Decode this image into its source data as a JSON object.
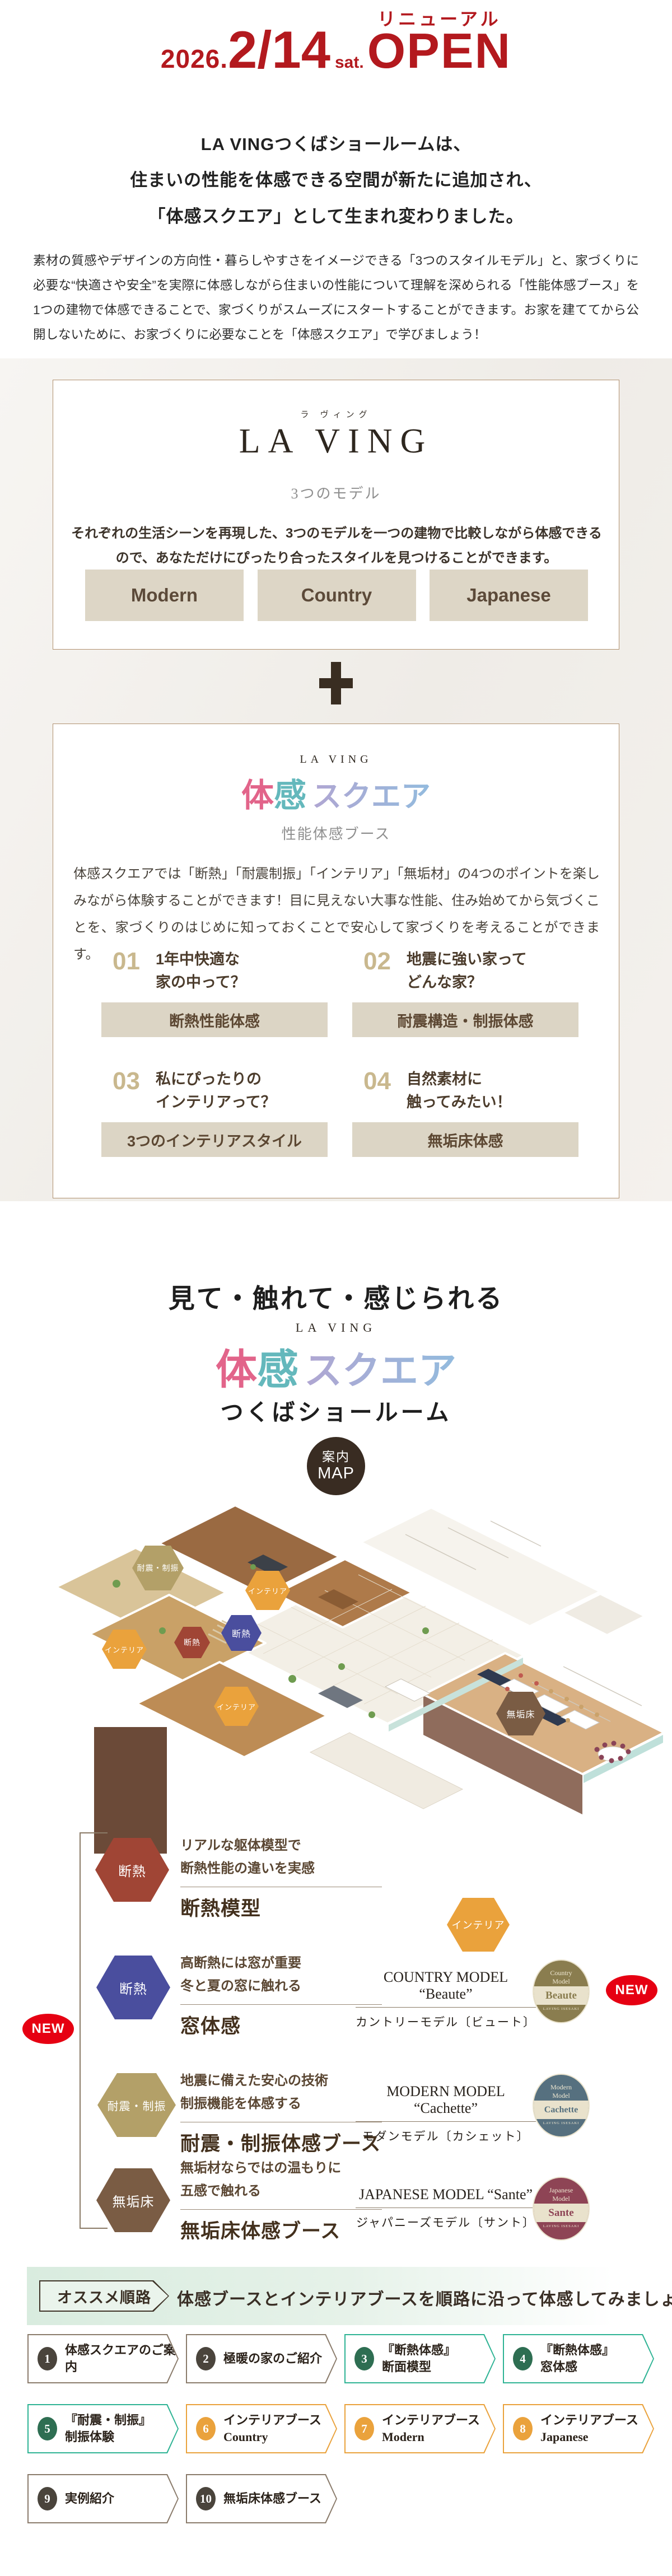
{
  "colors": {
    "accent_red": "#b3191e",
    "badge_red": "#e60012",
    "brown_text": "#4c3a2a",
    "beige_bg": "#f4f1ec",
    "button_beige": "#ddd6c6",
    "label_beige": "#dcd5c5",
    "hex_orange": "#eaa23c",
    "hex_navy": "#4a4e9e",
    "hex_brick": "#a04535",
    "hex_khaki": "#b3a068",
    "hex_brown": "#7a5c44",
    "route_green": "#2eb394",
    "route_orange": "#eaa23c",
    "route_brown": "#8a7b6b",
    "taikan_pink": "#e2648a",
    "taikan_teal": "#64b8bc",
    "taikan_purple": "#a8a4d4",
    "badge_olive": "#8a7d4f",
    "badge_slate": "#56707f",
    "badge_maroon": "#8e4455"
  },
  "header": {
    "year": "2026.",
    "date": "2/14",
    "day": "sat.",
    "renewal": "リニューアル",
    "open": "OPEN"
  },
  "intro": {
    "line1": "LA VINGつくばショールームは、",
    "line2": "住まいの性能を体感できる空間が新たに追加され、",
    "line3": "「体感スクエア」として生まれ変わりました。",
    "body": "素材の質感やデザインの方向性・暮らしやすさをイメージできる「3つのスタイルモデル」と、家づくりに必要な“快適さや安全”を実際に体感しながら住まいの性能について理解を深められる「性能体感ブース」を1つの建物で体感できることで、家づくりがスムーズにスタートすることができます。お家を建ててから公開しないために、お家づくりに必要なことを「体感スクエア」で学びましょう！"
  },
  "models_box": {
    "furigana": "ラ ヴィング",
    "logo": "LA VING",
    "subtitle": "3つのモデル",
    "description": "それぞれの生活シーンを再現した、3つのモデルを一つの建物で比較しながら体感できるので、あなただけにぴったり合ったスタイルを見つけることができます。",
    "buttons": [
      "Modern",
      "Country",
      "Japanese"
    ]
  },
  "taikan_box": {
    "logo": "LA VING",
    "title": {
      "part1": "体",
      "part2": "感",
      "part3": "スクエア"
    },
    "subtitle": "性能体感ブース",
    "description": "体感スクエアでは「断熱」「耐震制振」「インテリア」「無垢材」の4つのポイントを楽しみながら体験することができます！目に見えない大事な性能、住み始めてから気づくことを、家づくりのはじめに知っておくことで安心して家づくりを考えることができます。",
    "points": [
      {
        "num": "01",
        "q1": "1年中快適な",
        "q2": "家の中って？",
        "label": "断熱性能体感"
      },
      {
        "num": "02",
        "q1": "地震に強い家って",
        "q2": "どんな家？",
        "label": "耐震構造・制振体感"
      },
      {
        "num": "03",
        "q1": "私にぴったりの",
        "q2": "インテリアって？",
        "label": "3つのインテリアスタイル"
      },
      {
        "num": "04",
        "q1": "自然素材に",
        "q2": "触ってみたい！",
        "label": "無垢床体感"
      }
    ]
  },
  "showroom": {
    "catch": "見て・触れて・感じられる",
    "logo": "LA VING",
    "title": {
      "part1": "体",
      "part2": "感",
      "part3": "スクエア"
    },
    "subtitle": "つくばショールーム",
    "map_badge_line1": "案内",
    "map_badge_line2": "MAP"
  },
  "map": {
    "hexagons": [
      {
        "label": "耐震・制振"
      },
      {
        "label": "インテリア"
      },
      {
        "label": "断熱"
      },
      {
        "label": "断熱"
      },
      {
        "label": "インテリア"
      },
      {
        "label": "インテリア"
      },
      {
        "label": "無垢床"
      }
    ]
  },
  "legend": {
    "new_label": "NEW",
    "booths": [
      {
        "hex": "断熱",
        "desc1": "リアルな躯体模型で",
        "desc2": "断熱性能の違いを実感",
        "title": "断熱模型"
      },
      {
        "hex": "断熱",
        "desc1": "高断熱には窓が重要",
        "desc2": "冬と夏の窓に触れる",
        "title": "窓体感"
      },
      {
        "hex": "耐震・制振",
        "desc1": "地震に備えた安心の技術",
        "desc2": "制振機能を体感する",
        "title": "耐震・制振体感ブース"
      },
      {
        "hex": "無垢床",
        "desc1": "無垢材ならではの温もりに",
        "desc2": "五感で触れる",
        "title": "無垢床体感ブース"
      }
    ],
    "interior_hex": "インテリア",
    "models": [
      {
        "title": "COUNTRY MODEL “Beaute”",
        "jp": "カントリーモデル〔ビュート〕",
        "badge_top1": "Country",
        "badge_top2": "Model",
        "badge_name": "Beaute",
        "badge_bottom": "LAVING ISESAKI"
      },
      {
        "title": "MODERN MODEL “Cachette”",
        "jp": "モダンモデル〔カシェット〕",
        "badge_top1": "Modern",
        "badge_top2": "Model",
        "badge_name": "Cachette",
        "badge_bottom": "LAVING ISESAKI"
      },
      {
        "title": "JAPANESE MODEL “Sante”",
        "jp": "ジャパニーズモデル〔サント〕",
        "badge_top1": "Japanese",
        "badge_top2": "Model",
        "badge_name": "Sante",
        "badge_bottom": "LAVING ISESAKI"
      }
    ]
  },
  "route": {
    "tag": "オススメ順路",
    "heading": "体感ブースとインテリアブースを順路に沿って体感してみましょう",
    "steps": [
      {
        "num": "1",
        "line1": "体感スクエアのご案内",
        "line2": ""
      },
      {
        "num": "2",
        "line1": "極暖の家のご紹介",
        "line2": ""
      },
      {
        "num": "3",
        "line1": "『断熱体感』",
        "line2": "断面模型"
      },
      {
        "num": "4",
        "line1": "『断熱体感』",
        "line2": "窓体感"
      },
      {
        "num": "5",
        "line1": "『耐震・制振』",
        "line2": "制振体験"
      },
      {
        "num": "6",
        "line1": "インテリアブース",
        "line2": "Country"
      },
      {
        "num": "7",
        "line1": "インテリアブース",
        "line2": "Modern"
      },
      {
        "num": "8",
        "line1": "インテリアブース",
        "line2": "Japanese"
      },
      {
        "num": "9",
        "line1": "実例紹介",
        "line2": ""
      },
      {
        "num": "10",
        "line1": "無垢床体感ブース",
        "line2": ""
      }
    ]
  }
}
